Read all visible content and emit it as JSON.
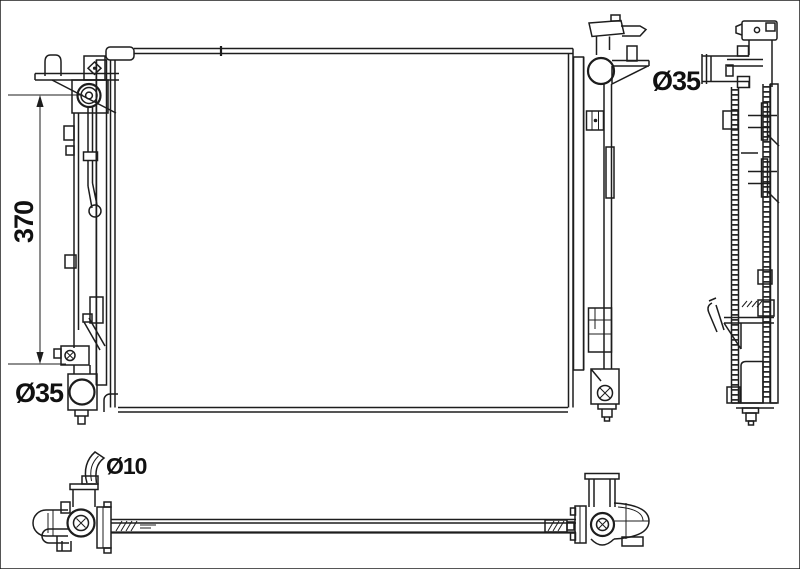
{
  "labels": {
    "height_mm": "370",
    "inlet_diameter": "Ø35",
    "outlet_diameter": "Ø35",
    "drain_tube_diameter": "Ø10"
  },
  "watermark": {
    "brand_letters": [
      "N",
      "R",
      "F"
    ],
    "color": "#e4e4e4"
  },
  "colors": {
    "line": "#1d1d1d",
    "background": "#ffffff",
    "label_text": "#111111"
  }
}
